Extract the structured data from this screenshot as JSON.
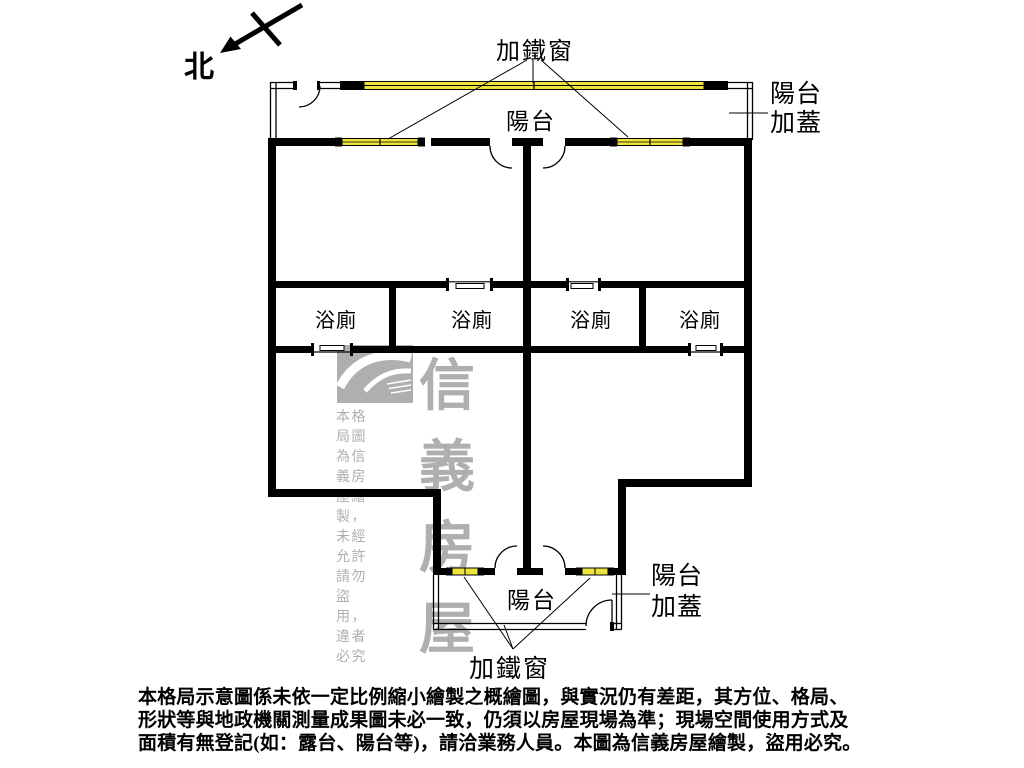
{
  "compass": {
    "label": "北"
  },
  "floorplan": {
    "labels": {
      "top_iron_window": "加鐵窗",
      "top_balcony": "陽台",
      "top_balcony_cover": {
        "line1": "陽台",
        "line2": "加蓋"
      },
      "bathrooms": [
        "浴廁",
        "浴廁",
        "浴廁",
        "浴廁"
      ],
      "bottom_balcony": "陽台",
      "bottom_balcony_cover": {
        "line1": "陽台",
        "line2": "加蓋"
      },
      "bottom_iron_window": "加鐵窗"
    },
    "colors": {
      "wall": "#000000",
      "window": "#EDE33C",
      "watermark": "#AFAFAF"
    }
  },
  "watermark": {
    "brand": "信義房屋",
    "notice": "本格局圖為信義房屋繪製，未經允許請勿盜用，違者必究"
  },
  "disclaimer": {
    "line1": "本格局示意圖係未依一定比例縮小繪製之概繪圖，與實況仍有差距，其方位、格局、",
    "line2": "形狀等與地政機關測量成果圖未必一致，仍須以房屋現場為準；現場空間使用方式及",
    "line3": "面積有無登記(如：露台、陽台等)，請洽業務人員。本圖為信義房屋繪製，盜用必究。"
  }
}
